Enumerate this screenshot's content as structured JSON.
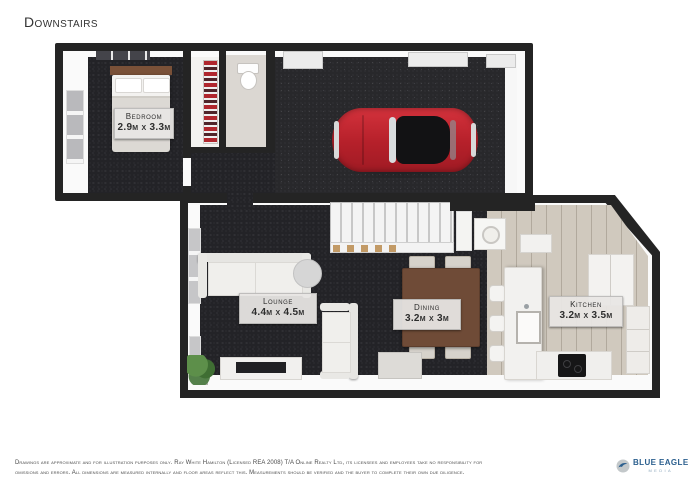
{
  "page": {
    "title": "Downstairs"
  },
  "rooms": {
    "bedroom": {
      "name": "Bedroom",
      "dims": "2.9m x 3.3m"
    },
    "lounge": {
      "name": "Lounge",
      "dims": "4.4m x 4.5m"
    },
    "dining": {
      "name": "Dining",
      "dims": "3.2m x 3m"
    },
    "kitchen": {
      "name": "Kitchen",
      "dims": "3.2m x 3.5m"
    }
  },
  "footer": {
    "line1": "Drawings are approximate and for illustration purposes only.  Ray White Hamilton (Licensed REA 2008) T/A Online Realty Ltd, its licensees and employees take no responsibility for",
    "line2": "omissions and errors.  All dimensions are measured internally and floor areas reflect this.  Measurements should be verified and the buyer to complete their own due diligence."
  },
  "logo": {
    "brand": "BLUE EAGLE",
    "subtitle": "MEDIA"
  },
  "colors": {
    "wall": "#242424",
    "carpet": "#232327",
    "garage-floor": "#28282b",
    "kitchen-floor": "#d0c9be",
    "car-red": "#bf2730",
    "label-bg": "#e8e6e3",
    "logo-blue": "#2b5f8e",
    "logo-light-blue": "#8fa9bd"
  }
}
